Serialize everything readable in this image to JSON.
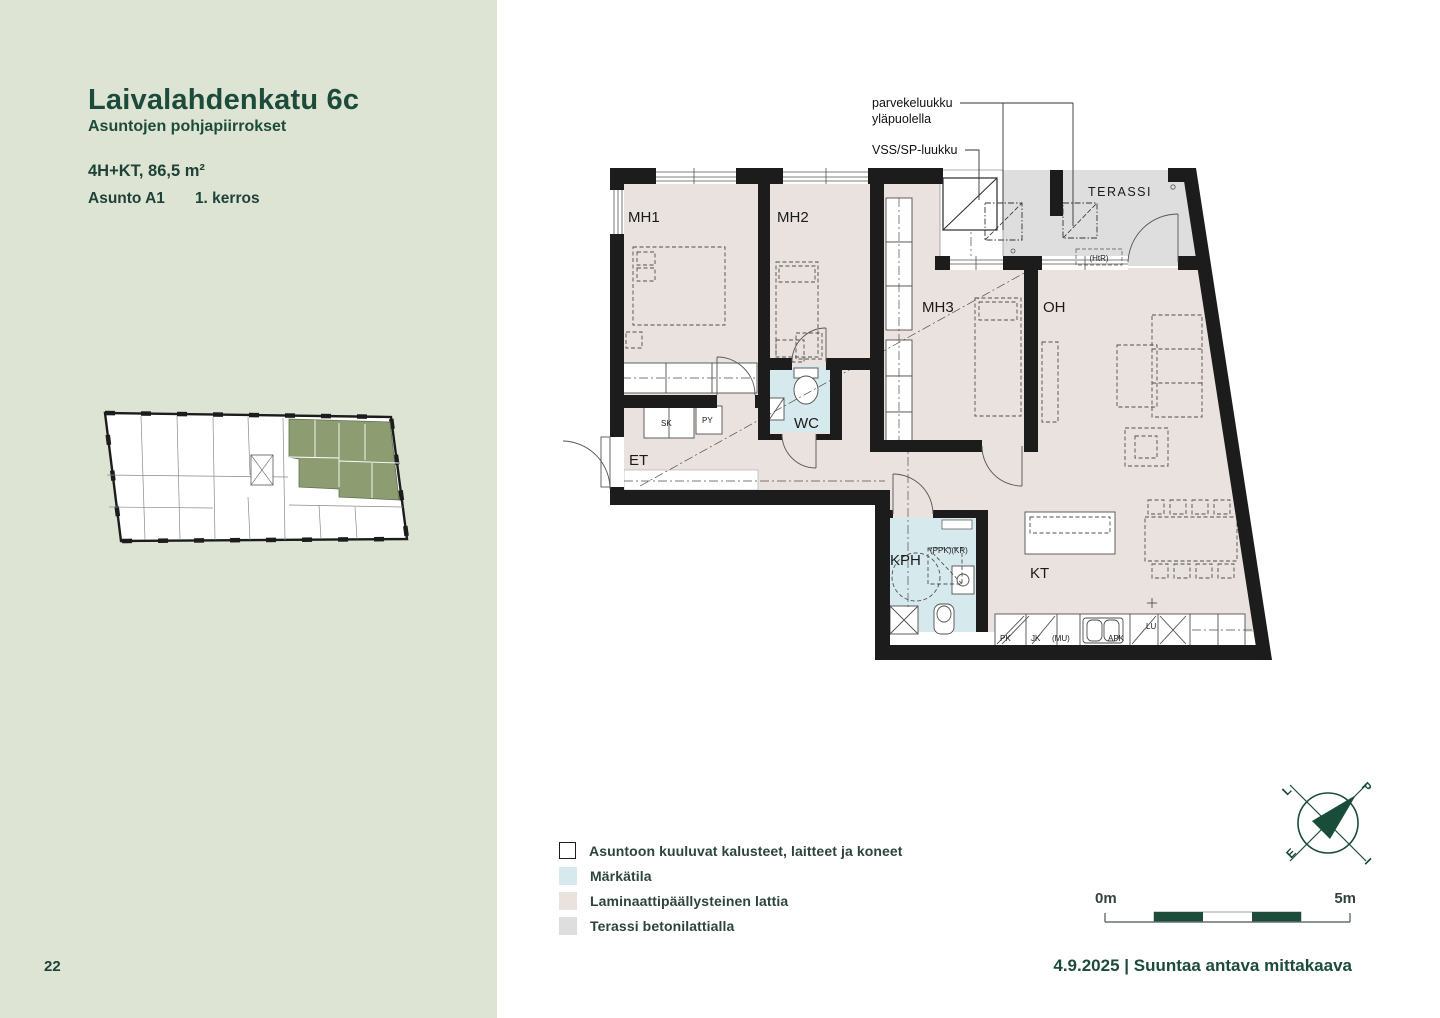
{
  "sidebar": {
    "title": "Laivalahdenkatu 6c",
    "subtitle": "Asuntojen pohjapiirrokset",
    "apartment_type": "4H+KT, 86,5 m²",
    "apartment_id": "Asunto A1",
    "floor": "1. kerros",
    "page_number": "22"
  },
  "plan": {
    "annotations": {
      "hatch_note_line1": "parvekeluukku",
      "hatch_note_line2": "yläpuolella",
      "vss_note": "VSS/SP-luukku"
    },
    "rooms": {
      "mh1": "MH1",
      "mh2": "MH2",
      "mh3": "MH3",
      "oh": "OH",
      "terassi": "TERASSI",
      "wc": "WC",
      "et": "ET",
      "kph": "KPH",
      "kt": "KT"
    },
    "small_labels": {
      "sk": "SK",
      "py": "PY",
      "rk": "RK",
      "ppk_kr": "(PPK)(KR)",
      "htr": "(HtR)",
      "pk": "PK",
      "jk": "JK",
      "mu": "(MU)",
      "apk": "APK",
      "lu": "LU"
    }
  },
  "legend": {
    "items": [
      {
        "label": "Asuntoon kuuluvat kalusteet, laitteet ja koneet",
        "swatch": "outline"
      },
      {
        "label": "Märkätila",
        "swatch": "wet"
      },
      {
        "label": "Laminaattipäällysteinen lattia",
        "swatch": "laminate"
      },
      {
        "label": "Terassi betonilattialla",
        "swatch": "terrace"
      }
    ]
  },
  "compass": {
    "north": "P",
    "east": "I",
    "south": "E",
    "west": "L"
  },
  "scale_bar": {
    "start": "0m",
    "end": "5m"
  },
  "footer": {
    "text": "4.9.2025 | Suuntaa antava mittakaava"
  },
  "colors": {
    "accent_green": "#1d4b3b",
    "sidebar_bg": "#dee4d3",
    "laminate_floor": "#eae2de",
    "wet_room": "#d6e9ec",
    "terrace_concrete": "#dedede",
    "wall": "#1c1c1c",
    "highlight_olive": "#8e9c72"
  }
}
